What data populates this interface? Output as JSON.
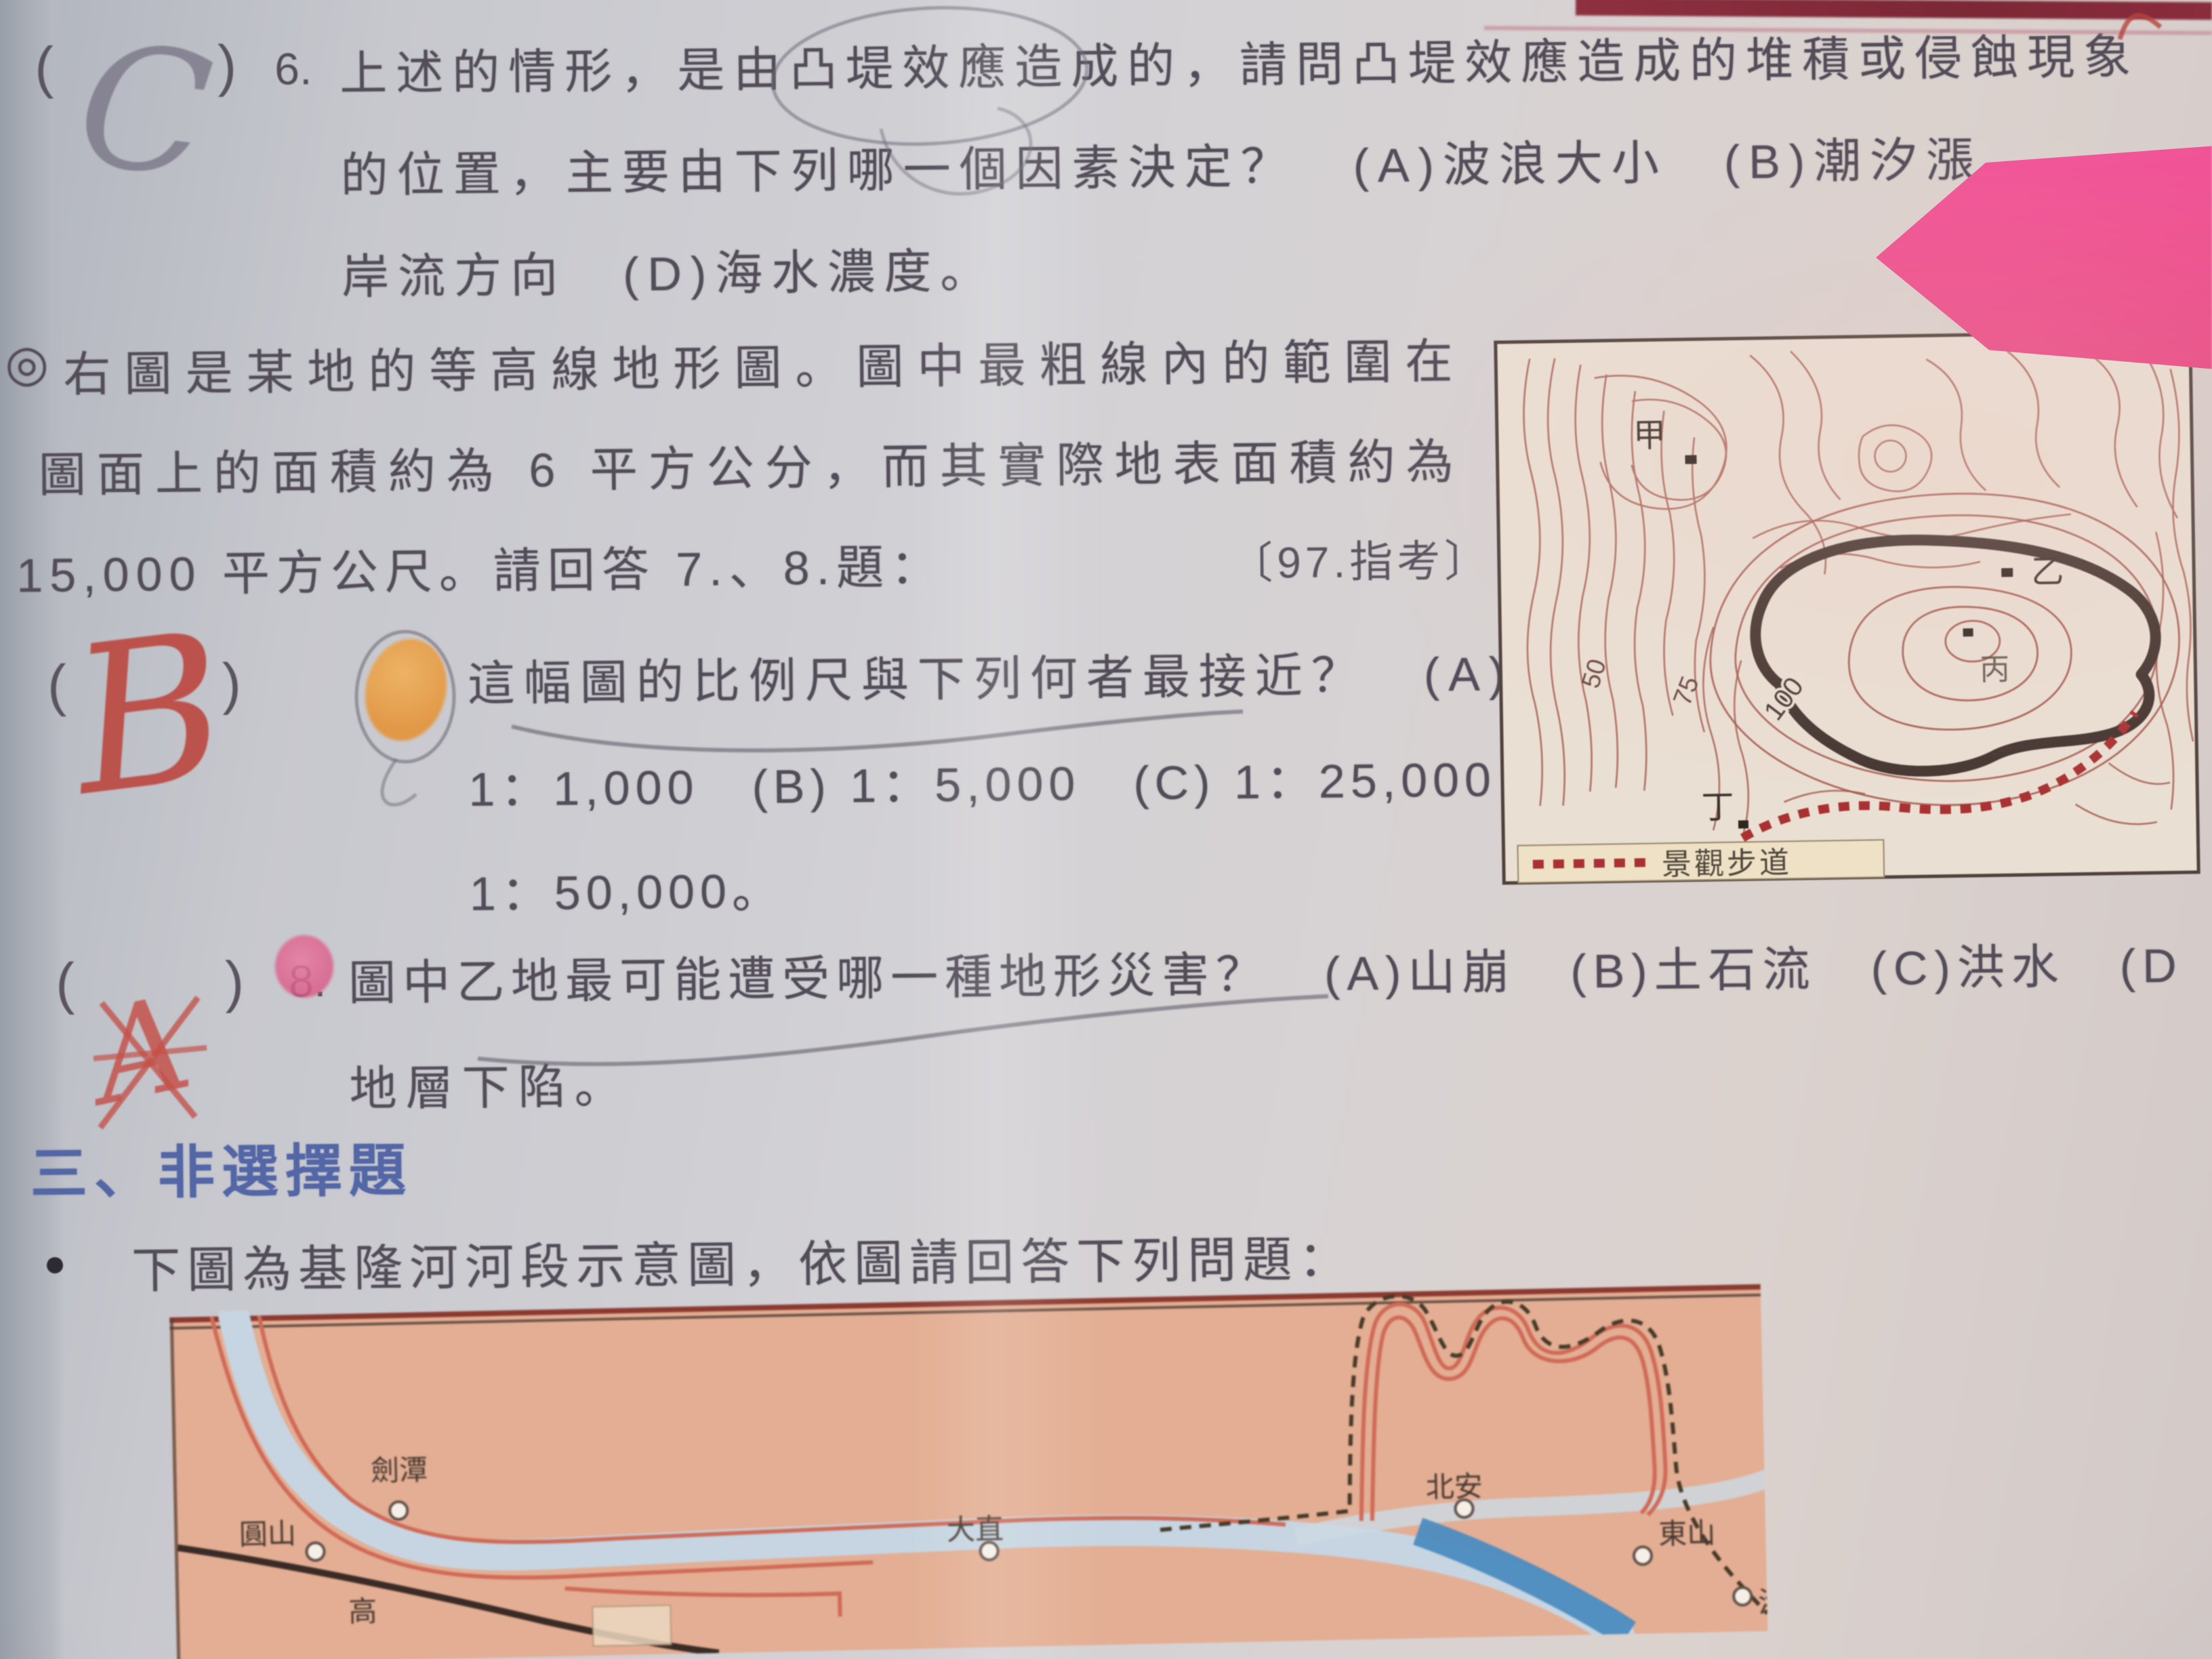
{
  "question6": {
    "answer_mark": "C",
    "number": "6.",
    "line1": "上述的情形，是由凸堤效應造成的，請問凸堤效應造成的堆積或侵蝕現象",
    "line2": "的位置，主要由下列哪一個因素決定？　(A)波浪大小　(B)潮汐漲",
    "line3": "岸流方向　(D)海水濃度。"
  },
  "stimulus": {
    "marker": "◎",
    "line1": "右圖是某地的等高線地形圖。圖中最粗線內的範圍在",
    "line2": "圖面上的面積約為 6 平方公分，而其實際地表面積約為",
    "line3": "15,000 平方公尺。請回答 7.、8.題：",
    "source": "〔97.指考〕"
  },
  "question7": {
    "answer_mark": "B",
    "line1": "這幅圖的比例尺與下列何者最接近？　(A)",
    "line2": "1：1,000　(B) 1：5,000　(C) 1：25,000　(D)",
    "line3": "1：50,000。"
  },
  "question8": {
    "number": "8.",
    "handwritten_mark": "A",
    "line1": "圖中乙地最可能遭受哪一種地形災害？　(A)山崩　(B)土石流　(C)洪水　(D",
    "line2": "地層下陷。"
  },
  "section3": {
    "title": "三、非選擇題"
  },
  "bullet_question": {
    "bullet": "●",
    "text": "下圖為基隆河河段示意圖，依圖請回答下列問題："
  },
  "topo_map": {
    "point_labels": [
      "甲",
      "乙",
      "丙",
      "丁"
    ],
    "contour_labels": [
      "50",
      "75",
      "100"
    ],
    "legend_label": "景觀步道"
  },
  "river_map": {
    "labels": [
      "劍潭",
      "圓山",
      "高",
      "大直",
      "北安",
      "東山",
      "港墘"
    ]
  },
  "colors": {
    "section_blue": "#5366a5",
    "handwriting_red": "#bb392f",
    "pencil_gray": "#767183",
    "sticky_pink": "#ee4e8d",
    "highlight_orange": "#e4953c",
    "marker_pink": "#d95c88",
    "topo_contour": "#a3564b",
    "river_bg": "#e3ae93",
    "river_water": "#c6d5e1",
    "river_cut_blue": "#4c8cc0"
  }
}
